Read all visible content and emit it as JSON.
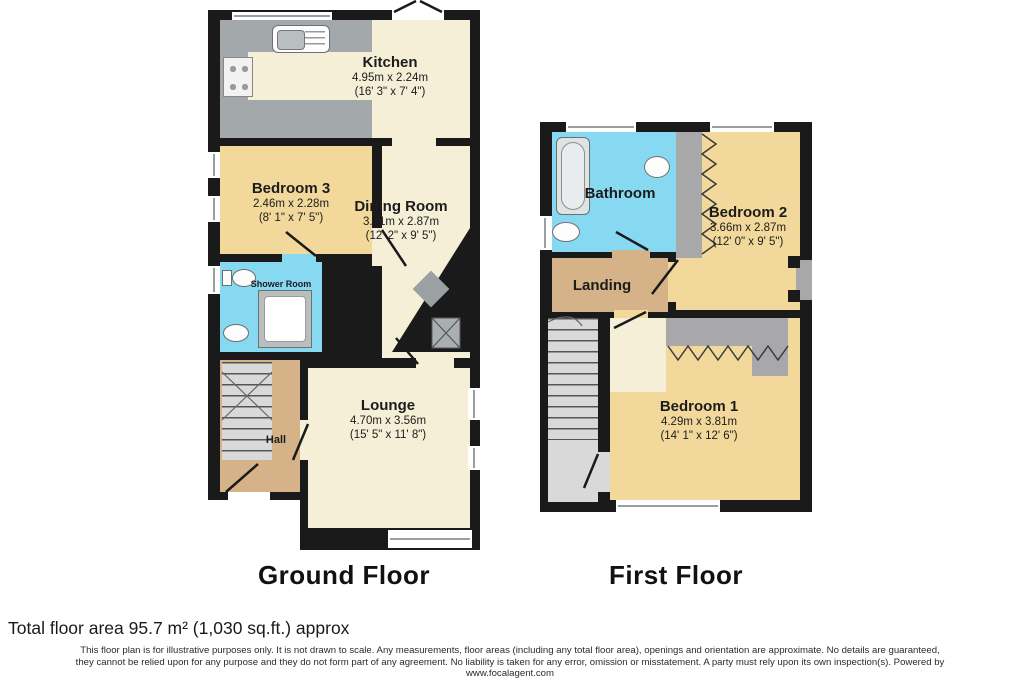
{
  "floors": {
    "ground": {
      "title": "Ground Floor"
    },
    "first": {
      "title": "First Floor"
    }
  },
  "rooms": {
    "kitchen": {
      "name": "Kitchen",
      "metric": "4.95m x 2.24m",
      "imperial": "(16' 3\" x 7' 4\")"
    },
    "bedroom3": {
      "name": "Bedroom 3",
      "metric": "2.46m x 2.28m",
      "imperial": "(8' 1\" x 7' 5\")"
    },
    "dining_room": {
      "name": "Dining Room",
      "metric": "3.71m x 2.87m",
      "imperial": "(12' 2\" x 9' 5\")"
    },
    "shower_room": {
      "name": "Shower Room"
    },
    "lounge": {
      "name": "Lounge",
      "metric": "4.70m x 3.56m",
      "imperial": "(15' 5\" x 11' 8\")"
    },
    "hall": {
      "name": "Hall"
    },
    "bathroom": {
      "name": "Bathroom"
    },
    "bedroom2": {
      "name": "Bedroom 2",
      "metric": "3.66m x 2.87m",
      "imperial": "(12' 0\" x 9' 5\")"
    },
    "landing": {
      "name": "Landing"
    },
    "bedroom1": {
      "name": "Bedroom 1",
      "metric": "4.29m x 3.81m",
      "imperial": "(14' 1\" x 12' 6\")"
    }
  },
  "footer": {
    "total_area": "Total floor area 95.7 m² (1,030 sq.ft.) approx",
    "disclaimer_line1": "This floor plan is for illustrative purposes only. It is not drawn to scale. Any measurements, floor areas (including any total floor area), openings and orientation are approximate. No details are guaranteed,",
    "disclaimer_line2": "they cannot be relied upon for any purpose and they do not form part of any agreement. No liability is taken for any error, omission or misstatement. A party must rely upon its own inspection(s). Powered by",
    "disclaimer_line3": "www.focalagent.com"
  },
  "palette": {
    "wall": "#1a1a1a",
    "floor_cream": "#f6efd8",
    "floor_yellow": "#f2d99b",
    "floor_blue": "#87d9f1",
    "floor_tan": "#d5b288",
    "counter_gray": "#a3a9ab",
    "stairs_gray": "#d9d9d9"
  }
}
